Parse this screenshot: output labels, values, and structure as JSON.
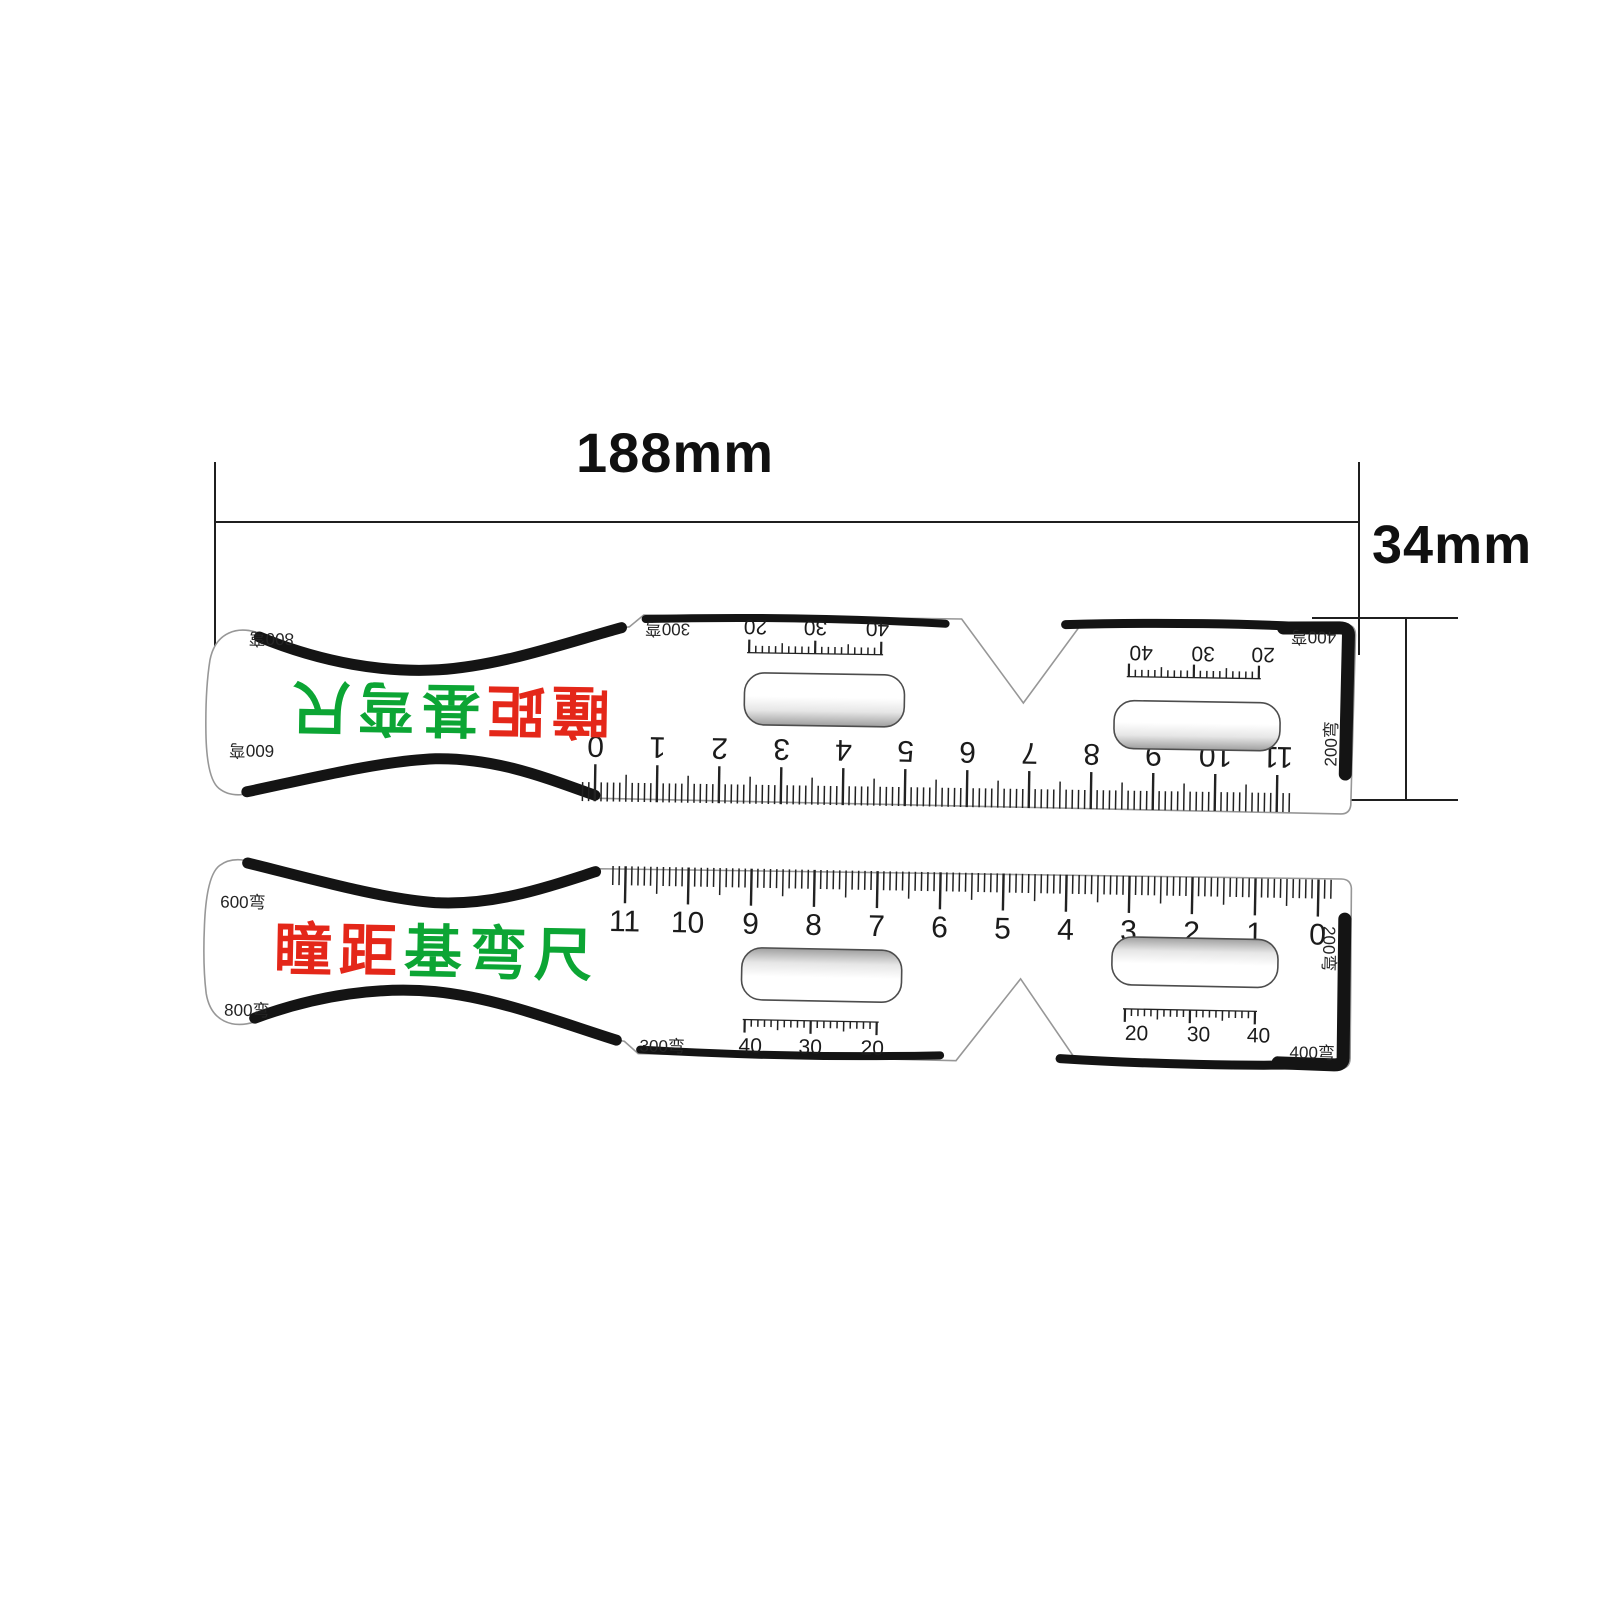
{
  "annotations": {
    "width_dimension": "188mm",
    "height_dimension": "34mm"
  },
  "colors": {
    "brand_red": "#e42719",
    "brand_green": "#0ca534",
    "ink": "#1b1b1b",
    "band_black": "#141414"
  },
  "ruler_top": {
    "description": "PD ruler shown with print rotated 180 degrees",
    "rotated_180": true,
    "title_segments": [
      {
        "text": "瞳距",
        "color": "#e42719"
      },
      {
        "text": "基弯尺",
        "color": "#0ca534"
      }
    ],
    "corner_labels": {
      "top_left": "800弯",
      "bottom_left": "600弯",
      "inner_left": "300弯",
      "top_right": "400弯",
      "right_vertical": "200弯"
    },
    "main_scale_numbers": [
      "0",
      "1",
      "2",
      "3",
      "4",
      "5",
      "6",
      "7",
      "8",
      "9",
      "10",
      "11"
    ],
    "left_lens_scale": [
      "20",
      "30",
      "40"
    ],
    "right_lens_scale": [
      "40",
      "30",
      "20"
    ]
  },
  "ruler_bottom": {
    "description": "PD ruler shown upright",
    "rotated_180": false,
    "title_segments": [
      {
        "text": "瞳距",
        "color": "#e42719"
      },
      {
        "text": "基弯尺",
        "color": "#0ca534"
      }
    ],
    "corner_labels": {
      "top_left": "600弯",
      "bottom_left": "800弯",
      "inner_left": "300弯",
      "bottom_right": "400弯",
      "right_vertical": "200弯"
    },
    "main_scale_numbers": [
      "11",
      "10",
      "9",
      "8",
      "7",
      "6",
      "5",
      "4",
      "3",
      "2",
      "1",
      "0"
    ],
    "left_lens_scale": [
      "40",
      "30",
      "20"
    ],
    "right_lens_scale": [
      "20",
      "30",
      "40"
    ]
  }
}
